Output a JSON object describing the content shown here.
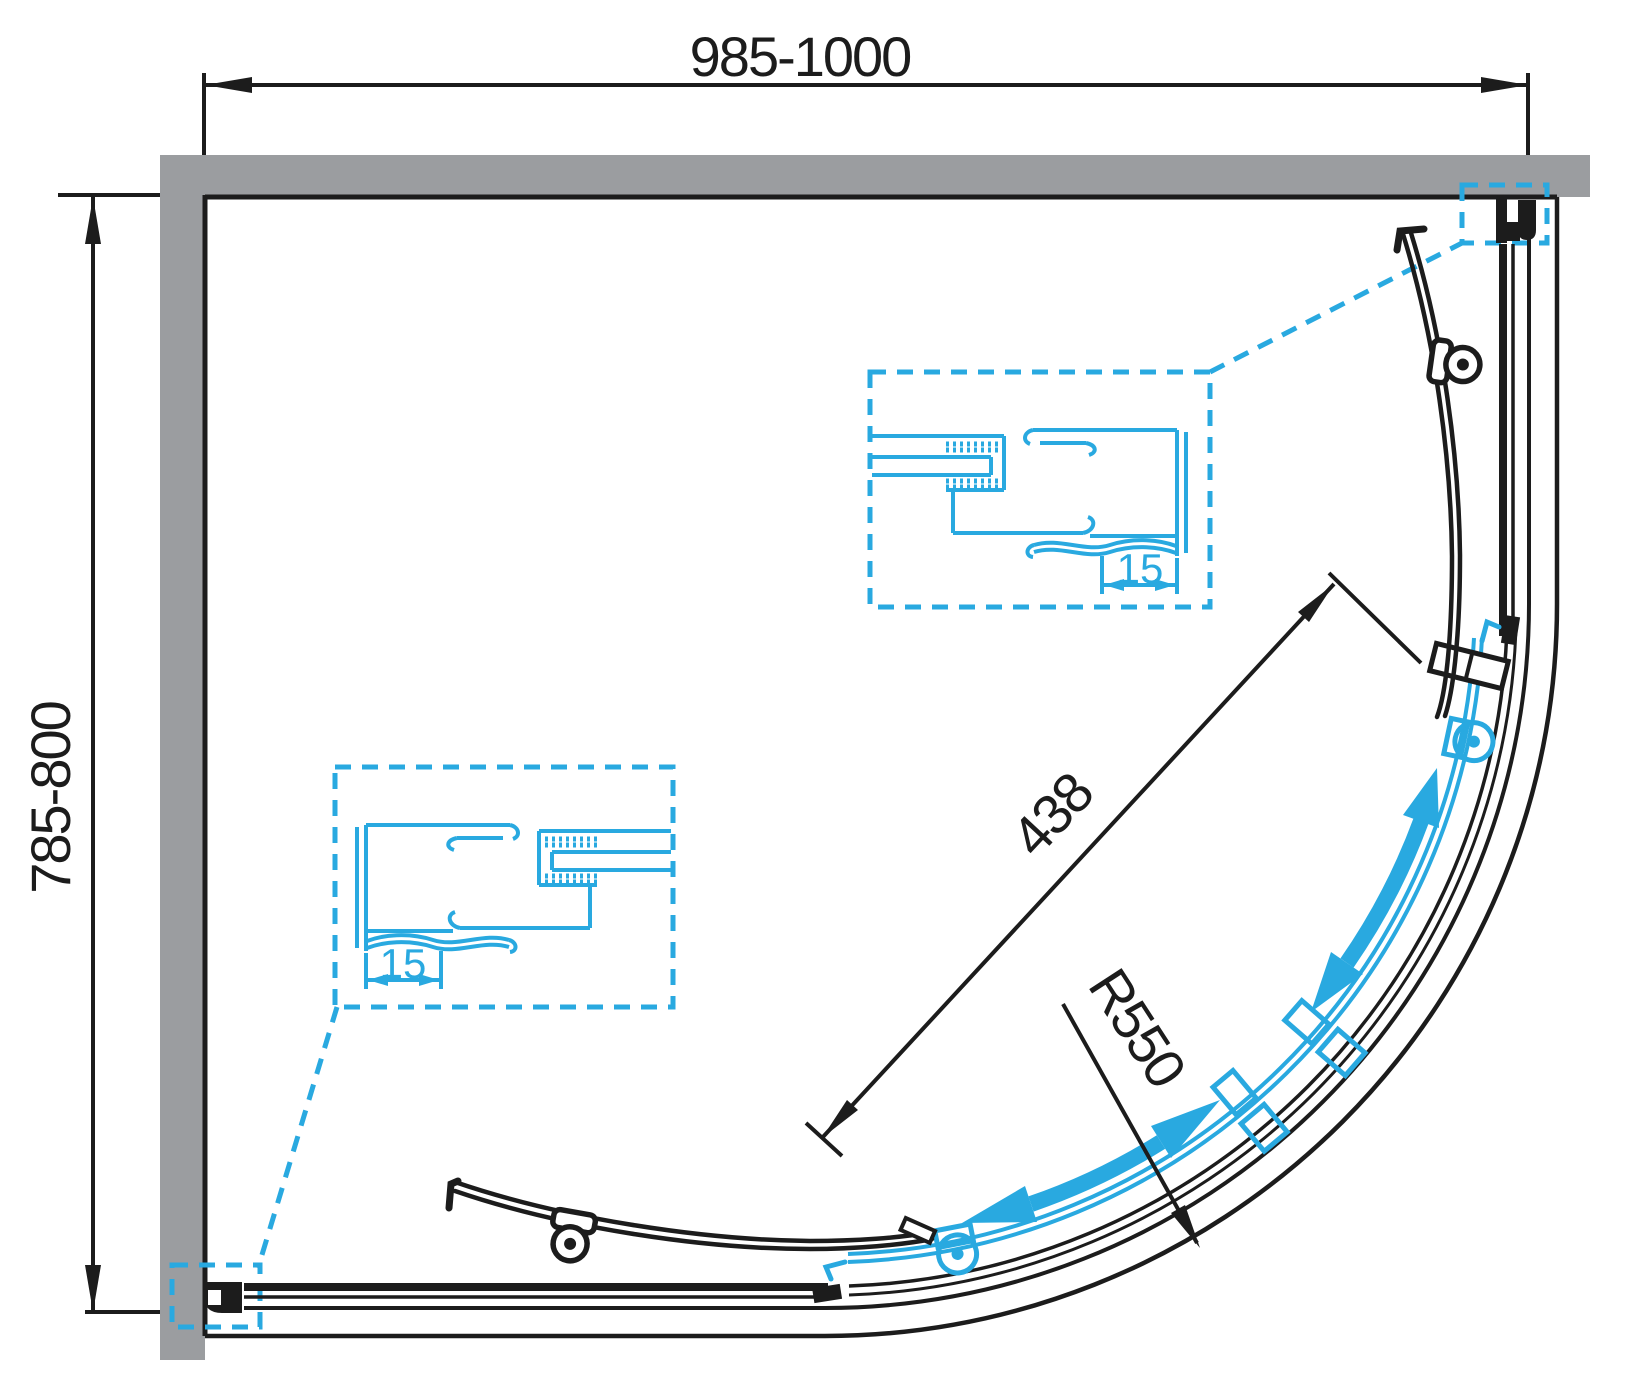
{
  "dimensions": {
    "width_range": "985-1000",
    "depth_range": "785-800",
    "door_opening": "438",
    "radius": "R550",
    "detail_upper_offset": "15",
    "detail_lower_offset": "15"
  },
  "colors": {
    "accent_cyan": "#29A9E0",
    "wall_gray": "#9B9DA0",
    "line_black": "#1c1c1c"
  }
}
